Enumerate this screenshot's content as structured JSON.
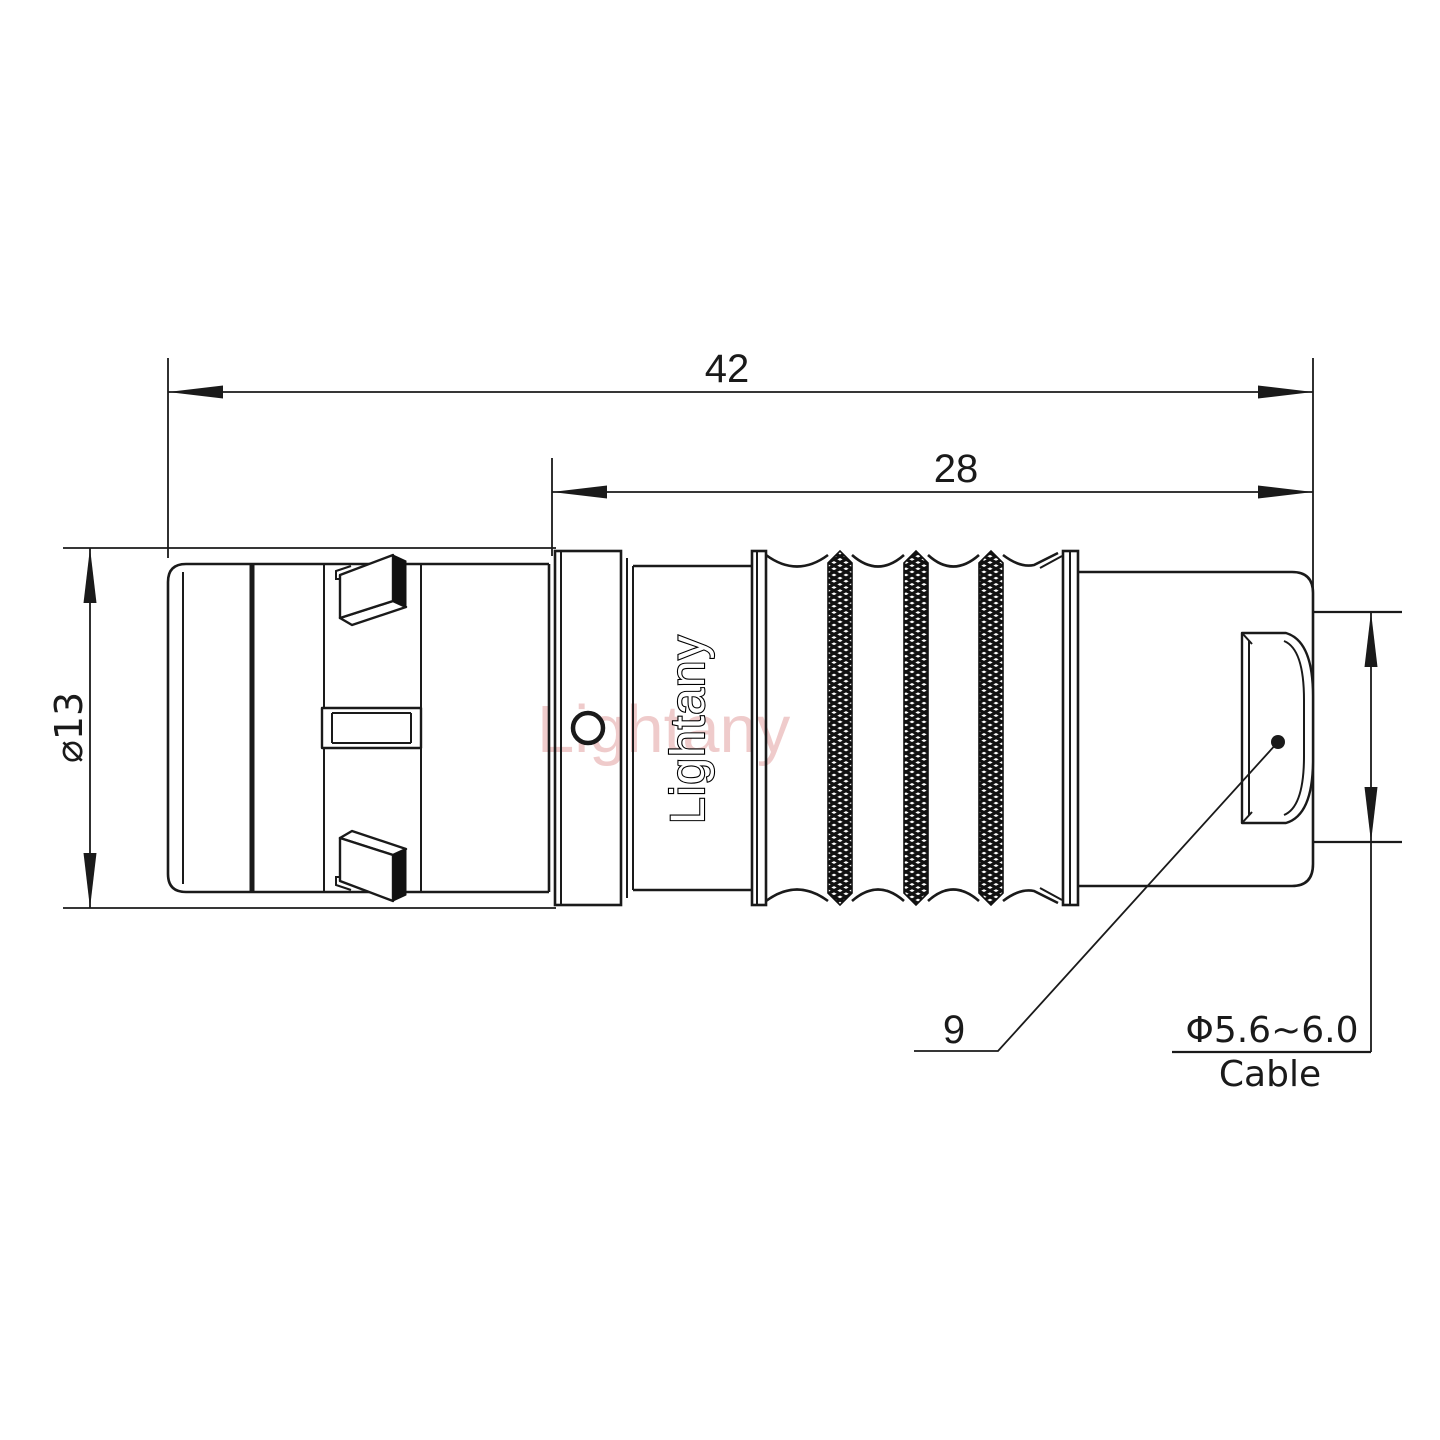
{
  "page": {
    "background": "#ffffff"
  },
  "drawing": {
    "brand": {
      "logo_text": "Lightany",
      "watermark_text": "Lightany"
    },
    "dimensions": {
      "overall_length": "42",
      "body_length": "28",
      "front_diameter": "⌀13",
      "shell_size": "9",
      "cable_range": "Φ5.6~6.0",
      "cable_label": "Cable"
    },
    "colors": {
      "line": "#1a1a1a",
      "watermark": "#d67676",
      "clip_side": "#111111",
      "background": "#ffffff"
    }
  }
}
